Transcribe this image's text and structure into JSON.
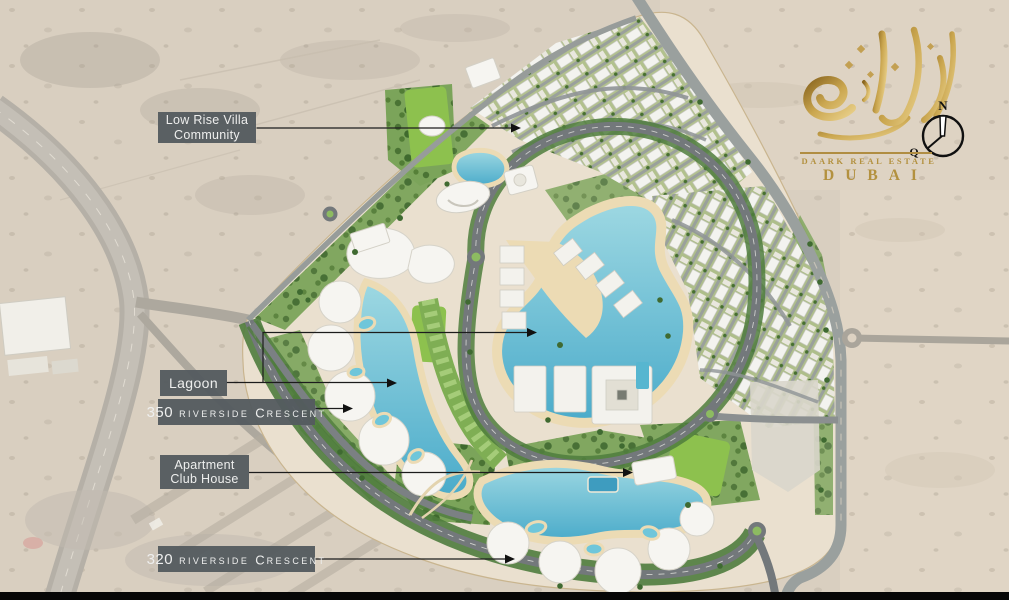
{
  "callouts": {
    "low_rise_villa": {
      "line1": "Low Rise Villa",
      "line2": "Community"
    },
    "lagoon": {
      "text": "Lagoon"
    },
    "riverside_350": {
      "number": "350",
      "word": "RIVERSIDE",
      "crescent_initial": "C",
      "crescent_rest": "RESCENT"
    },
    "apartment_club_house": {
      "line1": "Apartment",
      "line2": "Club House"
    },
    "riverside_320": {
      "number": "320",
      "word": "RIVERSIDE",
      "crescent_initial": "C",
      "crescent_rest": "RESCENT"
    }
  },
  "logo": {
    "brand": "DAARK REAL ESTATE",
    "city": "DUBAI",
    "compass": {
      "north": "N",
      "qibla": "Q"
    }
  },
  "colors": {
    "label_bg": "#545b5f",
    "label_text": "#f0f1f1",
    "gold": "#b3913f",
    "leader_line": "#1c1c1c",
    "sand": "#d9cfc0",
    "water": "#5fbcd3",
    "greenery": "#7ba45a",
    "road": "#73787b"
  },
  "map_features": [
    "desert",
    "highway-interchange",
    "low-rise-villa-community",
    "central-lagoon",
    "crescent-lagoon-350",
    "lagoon-320",
    "riverside-350-crescent-buildings",
    "riverside-320-crescent-buildings",
    "apartment-club-house",
    "sports-fields",
    "parks",
    "ring-road",
    "loop-road",
    "roundabouts"
  ]
}
